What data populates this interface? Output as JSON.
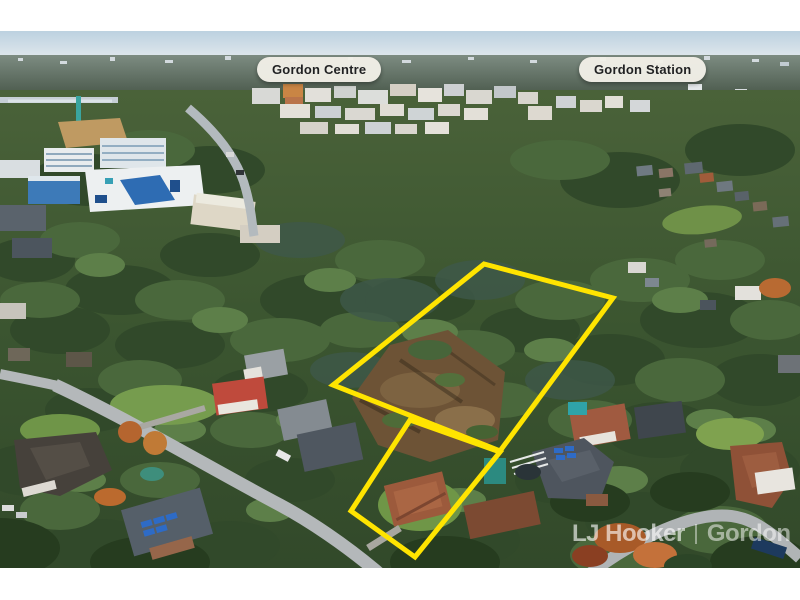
{
  "annotations": {
    "labels": [
      {
        "text": "Gordon Centre"
      },
      {
        "text": "Gordon Station"
      }
    ]
  },
  "watermark": {
    "brand": "LJ Hooker",
    "office": "Gordon"
  },
  "colors": {
    "boundary": "#ffe400",
    "label_bg": "#f2f0e8",
    "label_text": "#1e1e20",
    "watermark": "rgba(255,255,255,0.62)"
  }
}
